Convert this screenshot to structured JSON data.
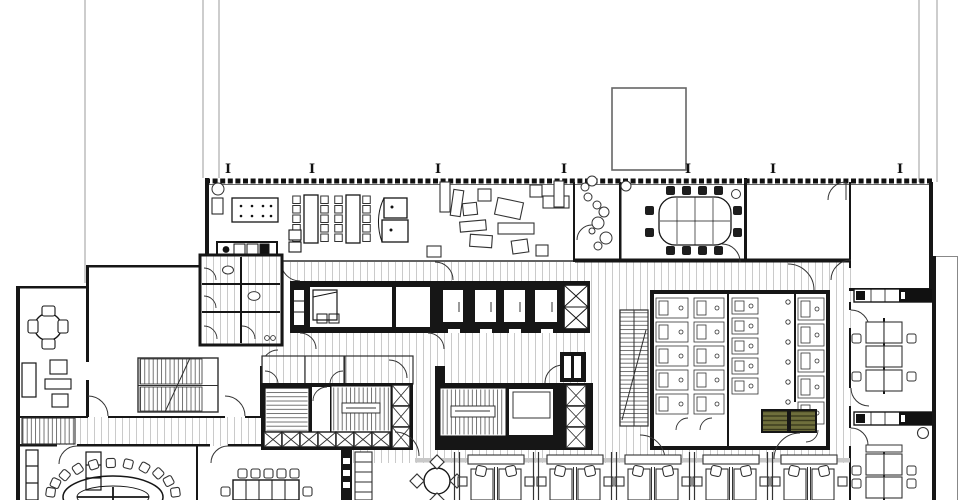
{
  "document": {
    "kind": "architectural-floor-plan",
    "description": "black-and-white office floor plan line drawing, no text labels visible",
    "visible_text": "none (only I-beam column marker glyphs along top facade)"
  },
  "colors": {
    "background": "#ffffff",
    "wall": "#161616",
    "line": "#2e2e2e",
    "hatch": "#b4b4b4",
    "rail_gray": "#c9c9c9",
    "site_line": "#9b9b9b",
    "shower_olive": "#6f6f3c",
    "shower_stripe": "#39391c"
  },
  "column_markers": {
    "glyph": "I",
    "y": 173,
    "xs": [
      228,
      312,
      438,
      564,
      688,
      773,
      900
    ]
  },
  "cafeteria": {
    "long_tables": [
      {
        "x": 304,
        "y": 195,
        "w": 14,
        "h": 48,
        "chair_cols": [
          293,
          321
        ]
      },
      {
        "x": 346,
        "y": 195,
        "w": 14,
        "h": 48,
        "chair_cols": [
          335,
          363
        ]
      }
    ],
    "chair_rows_y": [
      196,
      205.5,
      215,
      224.5,
      234
    ],
    "chair_size": 7.5,
    "dotted_table": {
      "x": 232,
      "y": 198,
      "w": 46,
      "h": 24,
      "dot_xs": [
        241,
        252,
        263,
        271
      ],
      "dot_ys": [
        206,
        216
      ]
    },
    "piano": {
      "rects": [
        [
          384,
          198,
          23,
          20
        ],
        [
          382,
          220,
          26,
          22
        ]
      ],
      "dots": [
        [
          392,
          207
        ],
        [
          391,
          230
        ]
      ]
    },
    "lockers": [
      [
        289,
        230,
        12,
        10
      ],
      [
        289,
        242,
        12,
        10
      ]
    ],
    "lounge_items": [
      [
        440,
        182,
        10,
        30,
        0
      ],
      [
        452,
        190,
        10,
        26,
        8
      ],
      [
        463,
        203,
        14,
        12,
        -6
      ],
      [
        478,
        189,
        13,
        12,
        0
      ],
      [
        496,
        200,
        26,
        17,
        12
      ],
      [
        498,
        223,
        36,
        11,
        0
      ],
      [
        512,
        240,
        16,
        13,
        -8
      ],
      [
        530,
        185,
        12,
        12,
        0
      ],
      [
        543,
        196,
        26,
        12,
        0
      ],
      [
        554,
        181,
        10,
        26,
        0
      ],
      [
        470,
        235,
        22,
        12,
        4
      ],
      [
        427,
        246,
        14,
        11,
        0
      ],
      [
        536,
        245,
        12,
        11,
        0
      ],
      [
        460,
        221,
        26,
        10,
        -5
      ]
    ],
    "plant_circles": [
      [
        585,
        187,
        4
      ],
      [
        592,
        181,
        5
      ],
      [
        588,
        197,
        4
      ],
      [
        597,
        205,
        4
      ],
      [
        604,
        212,
        5
      ],
      [
        598,
        223,
        6
      ],
      [
        592,
        231,
        3
      ],
      [
        606,
        238,
        6
      ],
      [
        598,
        246,
        4
      ],
      [
        626,
        186,
        5
      ],
      [
        736,
        194,
        4.5
      ],
      [
        218,
        189,
        6
      ]
    ]
  },
  "conference_room": {
    "table": {
      "x": 659,
      "y": 197,
      "w": 72,
      "h": 48,
      "rx": 16
    },
    "chairs_top_bottom_xs": [
      666,
      682,
      698,
      714
    ],
    "chairs_side_ys": [
      206,
      228
    ],
    "chair": 9
  },
  "oval_room": {
    "cx": 113,
    "cy": 497,
    "rx": 50,
    "ry": 21,
    "chair_rx": 63,
    "chair_ry": 34,
    "angles_deg": [
      188,
      204,
      220,
      236,
      252,
      268,
      284,
      300,
      316,
      332,
      352
    ],
    "chair": 9
  },
  "rect_room": {
    "table": {
      "x": 233,
      "y": 480,
      "w": 66,
      "h": 20
    },
    "chair_top_xs": [
      238,
      251,
      264,
      277,
      290
    ],
    "chair_top_y": 469,
    "side_chairs": [
      [
        221,
        487
      ],
      [
        303,
        487
      ]
    ]
  },
  "workstations": {
    "centers_x": [
      496,
      575,
      653,
      731,
      809
    ],
    "divider_xs": [
      457,
      536,
      614,
      692,
      770
    ],
    "round_table": {
      "cx": 437,
      "cy": 481,
      "r": 13
    }
  },
  "right_wing": {
    "room1_cluster": {
      "cx": 884,
      "rows": [
        322,
        346,
        370
      ],
      "spine_top": 318,
      "spine_bot": 394
    },
    "room2_cluster": {
      "cx": 884,
      "rows": [
        454,
        477
      ],
      "spine_top": 450,
      "spine_bot": 500
    },
    "chair": 9,
    "plant": [
      923,
      433,
      5.5
    ]
  },
  "toilet_core": {
    "stall_columns": [
      {
        "x": 656,
        "w": 32,
        "y0": 298,
        "dy": 24,
        "count": 5
      },
      {
        "x": 694,
        "w": 30,
        "y0": 298,
        "dy": 24,
        "count": 5
      },
      {
        "x": 732,
        "w": 26,
        "y0": 298,
        "dy": 20,
        "count": 5
      },
      {
        "x": 798,
        "w": 26,
        "y0": 298,
        "dy": 26,
        "count": 5
      }
    ],
    "showers": [
      [
        762,
        410,
        26,
        22
      ],
      [
        790,
        410,
        26,
        22
      ]
    ],
    "sink_dots": {
      "x": 788,
      "y0": 302,
      "dy": 20,
      "count": 7
    }
  }
}
